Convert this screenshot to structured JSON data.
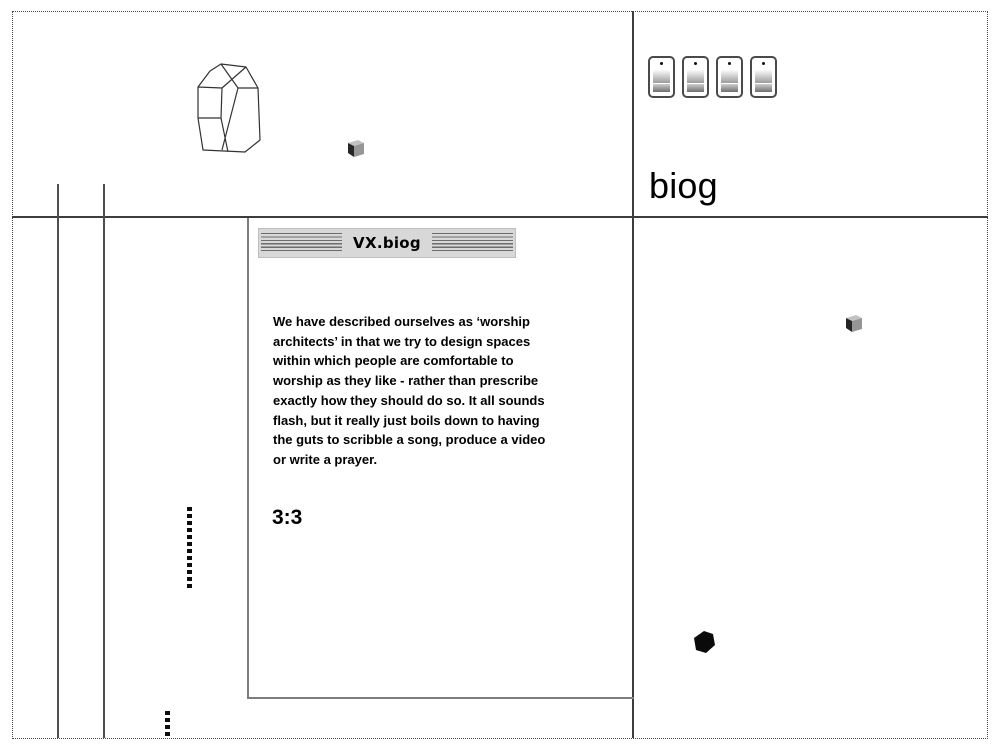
{
  "page": {
    "title": "biog",
    "background": "#ffffff",
    "frame_border_color": "#4a4a4a",
    "rule_color": "#3d3d3d"
  },
  "panel": {
    "titlebar_title": "VX.biog",
    "titlebar_bg": "#d8d8d8",
    "body_lines": [
      "We have described ourselves as ‘worship",
      "architects’ in that we try to design spaces",
      "within which people are comfortable to",
      "worship as they like - rather than prescribe",
      "exactly how they should do so. It all sounds",
      "flash, but it really just boils down to having",
      "the guts to scribble a song, produce a video",
      "or write a prayer."
    ],
    "verse_ref": "3:3"
  },
  "icons": {
    "switches": [
      "switch-icon",
      "switch-icon",
      "switch-icon",
      "switch-icon"
    ],
    "crystal": "crystal-wireframe-icon",
    "cube_top_left_area": "cube-icon",
    "cube_right_area": "cube-icon",
    "black_cube": "black-cube-icon"
  },
  "colors": {
    "cube_light_face": "#c2c2c2",
    "cube_mid_face": "#969696",
    "cube_dark_face": "#262626",
    "black_cube": "#0a0a0a",
    "panel_border": "#7d7d7d"
  }
}
